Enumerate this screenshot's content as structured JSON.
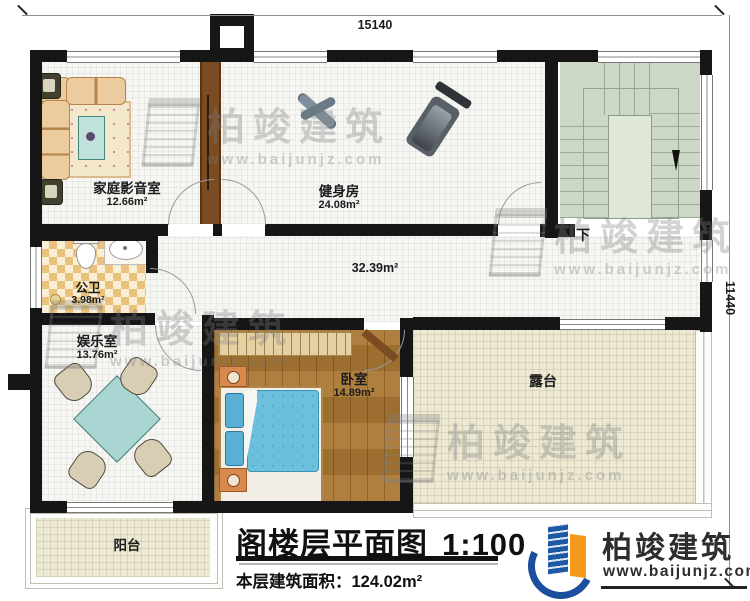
{
  "dimensions": {
    "width": "15140",
    "depth": "11440"
  },
  "rooms": {
    "media": {
      "name": "家庭影音室",
      "area": "12.66m²"
    },
    "gym": {
      "name": "健身房",
      "area": "24.08m²"
    },
    "bath": {
      "name": "公卫",
      "area": "3.98m²"
    },
    "play": {
      "name": "娱乐室",
      "area": "13.76m²"
    },
    "bed": {
      "name": "卧室",
      "area": "14.89m²"
    },
    "hall": {
      "area": "32.39m²"
    },
    "terrace": {
      "name": "露台"
    },
    "balcony": {
      "name": "阳台"
    },
    "stairs": {
      "direction": "下"
    }
  },
  "title_block": {
    "title": "阁楼层平面图",
    "scale": "1:100",
    "area_label": "本层建筑面积：",
    "area_value": "124.02m²"
  },
  "brand": {
    "name": "柏竣建筑",
    "website": "www.baijunjz.com"
  },
  "watermark": {
    "name": "柏竣建筑",
    "website": "www.baijunjz.com"
  }
}
